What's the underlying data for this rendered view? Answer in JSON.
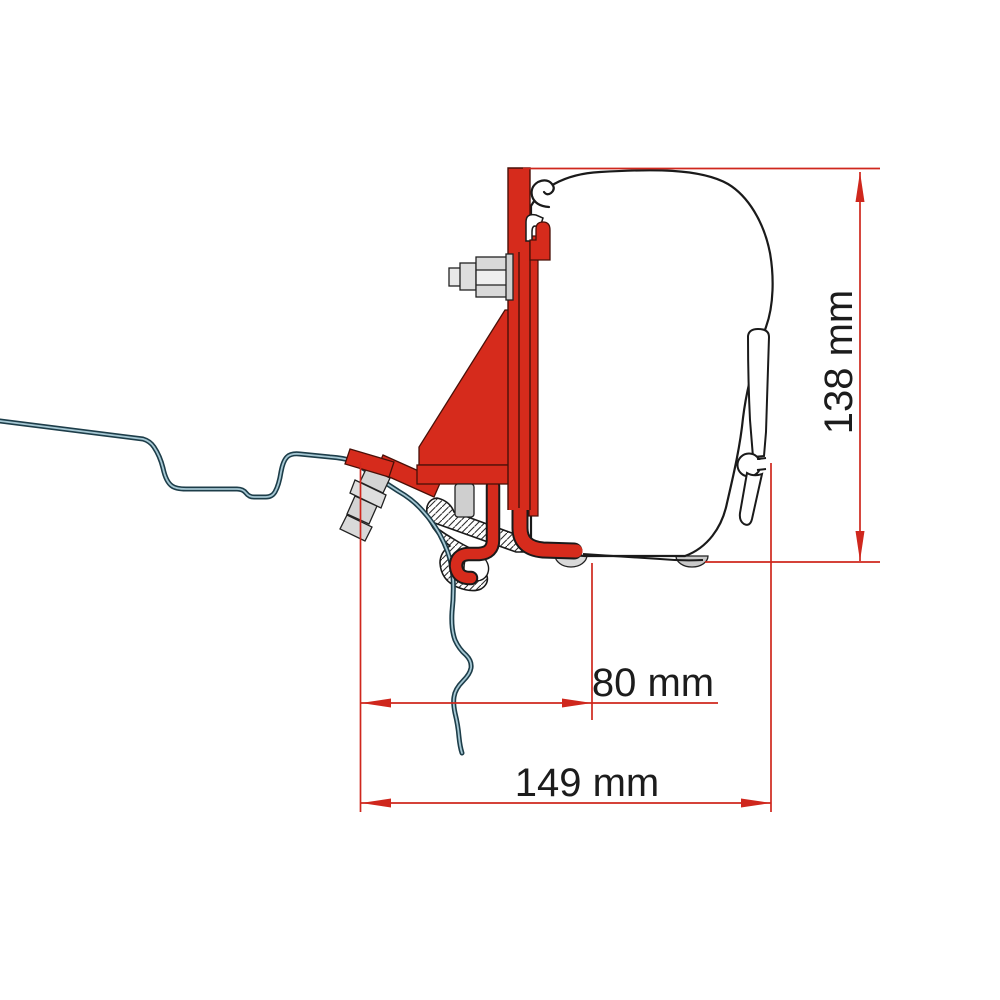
{
  "diagram": {
    "title": "awning-adapter-bracket-side-view",
    "dimensions": {
      "offset_width": "80 mm",
      "total_width": "149 mm",
      "total_height": "138 mm"
    },
    "colors": {
      "dimension_red": "#cf271d",
      "bracket_red": "#d62b1c",
      "outline_black": "#1a1a1a",
      "roof_line_dark": "#1d3d49",
      "roof_line_light": "#a6c8d4",
      "metal_gray": "#d9d9d9"
    }
  }
}
